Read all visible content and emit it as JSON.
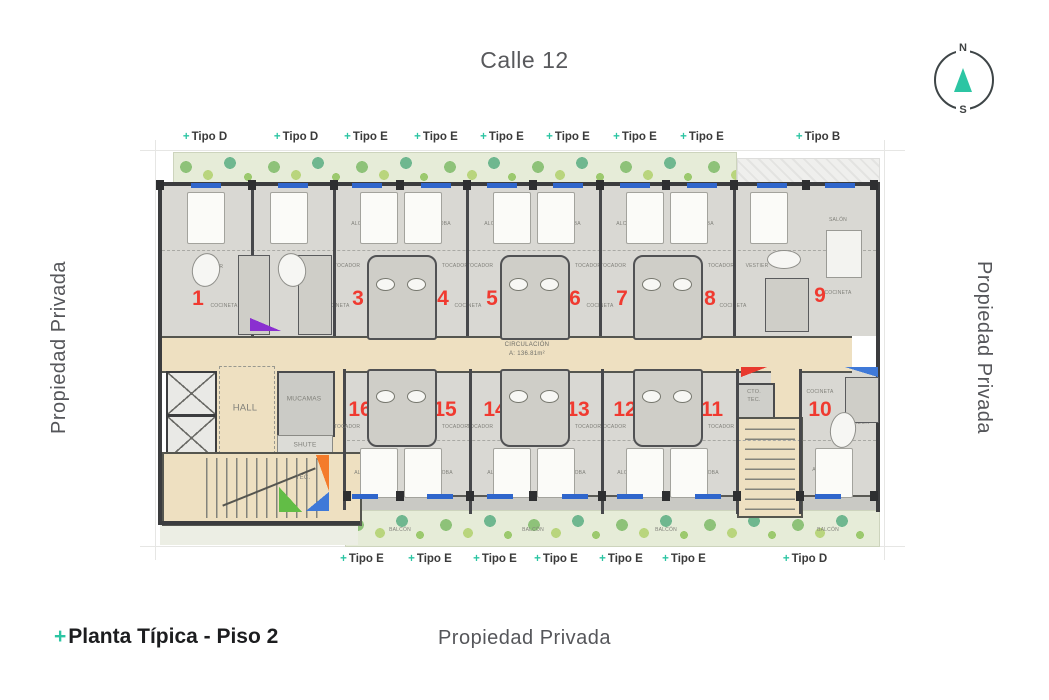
{
  "street_label": "Calle 12",
  "compass": {
    "north": "N",
    "south": "S",
    "needle_color": "#2cc5a3"
  },
  "side_labels": {
    "left": "Propiedad Privada",
    "right": "Propiedad Privada",
    "bottom": "Propiedad Privada"
  },
  "title": {
    "plus": "+",
    "text": "Planta Típica - Piso 2"
  },
  "colors": {
    "accent_teal": "#2cc5a3",
    "unit_number_red": "#f03a30",
    "corridor_beige": "#eee0c1",
    "building_gray": "#d9d8d3",
    "window_blue": "#2f66cc",
    "greenery_green": "#8ec279"
  },
  "corridor": {
    "line1": "CIRCULACIÓN",
    "line2": "A: 136.81m²"
  },
  "plan": {
    "type_labels_top": [
      {
        "label": "Tipo D",
        "x": 205
      },
      {
        "label": "Tipo D",
        "x": 296
      },
      {
        "label": "Tipo E",
        "x": 366
      },
      {
        "label": "Tipo E",
        "x": 436
      },
      {
        "label": "Tipo E",
        "x": 502
      },
      {
        "label": "Tipo E",
        "x": 568
      },
      {
        "label": "Tipo E",
        "x": 635
      },
      {
        "label": "Tipo E",
        "x": 702
      },
      {
        "label": "Tipo B",
        "x": 818
      }
    ],
    "type_labels_bottom": [
      {
        "label": "Tipo E",
        "x": 362
      },
      {
        "label": "Tipo E",
        "x": 430
      },
      {
        "label": "Tipo E",
        "x": 495
      },
      {
        "label": "Tipo E",
        "x": 556
      },
      {
        "label": "Tipo E",
        "x": 621
      },
      {
        "label": "Tipo E",
        "x": 684
      },
      {
        "label": "Tipo D",
        "x": 805
      }
    ],
    "unit_numbers": [
      {
        "n": "1",
        "x": 198,
        "y": 299
      },
      {
        "n": "2",
        "x": 310,
        "y": 299
      },
      {
        "n": "3",
        "x": 358,
        "y": 299
      },
      {
        "n": "4",
        "x": 443,
        "y": 299
      },
      {
        "n": "5",
        "x": 492,
        "y": 299
      },
      {
        "n": "6",
        "x": 575,
        "y": 299
      },
      {
        "n": "7",
        "x": 622,
        "y": 299
      },
      {
        "n": "8",
        "x": 710,
        "y": 299
      },
      {
        "n": "9",
        "x": 820,
        "y": 296
      },
      {
        "n": "10",
        "x": 820,
        "y": 410
      },
      {
        "n": "11",
        "x": 712,
        "y": 410
      },
      {
        "n": "12",
        "x": 625,
        "y": 410
      },
      {
        "n": "13",
        "x": 578,
        "y": 410
      },
      {
        "n": "14",
        "x": 495,
        "y": 410
      },
      {
        "n": "15",
        "x": 445,
        "y": 410
      },
      {
        "n": "16",
        "x": 360,
        "y": 410
      }
    ],
    "room_labels": [
      {
        "t": "HALL",
        "x": 245,
        "y": 408,
        "s": 9.5
      },
      {
        "t": "MUCAMAS",
        "x": 304,
        "y": 399,
        "s": 6.5
      },
      {
        "t": "SHUTE",
        "x": 305,
        "y": 445,
        "s": 6.5
      },
      {
        "t": "TEC.",
        "x": 303,
        "y": 478,
        "s": 6
      },
      {
        "t": "CTO.",
        "x": 754,
        "y": 392,
        "s": 5.5
      },
      {
        "t": "TEC.",
        "x": 754,
        "y": 400,
        "s": 5.5
      },
      {
        "t": "ALCOBA",
        "x": 205,
        "y": 224
      },
      {
        "t": "ALCOBA",
        "x": 292,
        "y": 224
      },
      {
        "t": "ALCOBA",
        "x": 362,
        "y": 224
      },
      {
        "t": "ALCOBA",
        "x": 440,
        "y": 224
      },
      {
        "t": "ALCOBA",
        "x": 495,
        "y": 224
      },
      {
        "t": "ALCOBA",
        "x": 570,
        "y": 224
      },
      {
        "t": "ALCOBA",
        "x": 627,
        "y": 224
      },
      {
        "t": "ALCOBA",
        "x": 703,
        "y": 224
      },
      {
        "t": "ALCOBA",
        "x": 770,
        "y": 220
      },
      {
        "t": "SALÓN",
        "x": 838,
        "y": 220
      },
      {
        "t": "TOCADOR",
        "x": 210,
        "y": 267
      },
      {
        "t": "TOCADOR",
        "x": 293,
        "y": 267
      },
      {
        "t": "TOCADOR",
        "x": 347,
        "y": 266
      },
      {
        "t": "TOCADOR",
        "x": 455,
        "y": 266
      },
      {
        "t": "TOCADOR",
        "x": 480,
        "y": 266
      },
      {
        "t": "TOCADOR",
        "x": 588,
        "y": 266
      },
      {
        "t": "TOCADOR",
        "x": 613,
        "y": 266
      },
      {
        "t": "TOCADOR",
        "x": 721,
        "y": 266
      },
      {
        "t": "VESTIER",
        "x": 757,
        "y": 266
      },
      {
        "t": "BAÑO",
        "x": 248,
        "y": 291
      },
      {
        "t": "BAÑO",
        "x": 313,
        "y": 291
      },
      {
        "t": "BAÑO",
        "x": 385,
        "y": 289
      },
      {
        "t": "BAÑO",
        "x": 415,
        "y": 289
      },
      {
        "t": "BAÑO",
        "x": 518,
        "y": 289
      },
      {
        "t": "BAÑO",
        "x": 548,
        "y": 289
      },
      {
        "t": "BAÑO",
        "x": 651,
        "y": 289
      },
      {
        "t": "BAÑO",
        "x": 681,
        "y": 289
      },
      {
        "t": "BAÑO",
        "x": 790,
        "y": 291
      },
      {
        "t": "COCINETA",
        "x": 224,
        "y": 306
      },
      {
        "t": "COCINETA",
        "x": 336,
        "y": 306
      },
      {
        "t": "COCINETA",
        "x": 384,
        "y": 306
      },
      {
        "t": "COCINETA",
        "x": 468,
        "y": 306
      },
      {
        "t": "COCINETA",
        "x": 517,
        "y": 306
      },
      {
        "t": "COCINETA",
        "x": 600,
        "y": 306
      },
      {
        "t": "COCINETA",
        "x": 650,
        "y": 306
      },
      {
        "t": "COCINETA",
        "x": 733,
        "y": 306
      },
      {
        "t": "COCINETA",
        "x": 838,
        "y": 293
      },
      {
        "t": "COCINETA",
        "x": 385,
        "y": 390
      },
      {
        "t": "COCINETA",
        "x": 420,
        "y": 390
      },
      {
        "t": "COCINETA",
        "x": 518,
        "y": 390
      },
      {
        "t": "COCINETA",
        "x": 553,
        "y": 390
      },
      {
        "t": "COCINETA",
        "x": 651,
        "y": 390
      },
      {
        "t": "COCINETA",
        "x": 686,
        "y": 390
      },
      {
        "t": "COCINETA",
        "x": 820,
        "y": 392
      },
      {
        "t": "BAÑO",
        "x": 383,
        "y": 401
      },
      {
        "t": "BAÑO",
        "x": 417,
        "y": 401
      },
      {
        "t": "BAÑO",
        "x": 516,
        "y": 401
      },
      {
        "t": "BAÑO",
        "x": 550,
        "y": 401
      },
      {
        "t": "BAÑO",
        "x": 649,
        "y": 401
      },
      {
        "t": "BAÑO",
        "x": 683,
        "y": 401
      },
      {
        "t": "BAÑO",
        "x": 853,
        "y": 399
      },
      {
        "t": "TOCADOR",
        "x": 347,
        "y": 427
      },
      {
        "t": "TOCADOR",
        "x": 455,
        "y": 427
      },
      {
        "t": "TOCADOR",
        "x": 480,
        "y": 427
      },
      {
        "t": "TOCADOR",
        "x": 588,
        "y": 427
      },
      {
        "t": "TOCADOR",
        "x": 613,
        "y": 427
      },
      {
        "t": "TOCADOR",
        "x": 721,
        "y": 427
      },
      {
        "t": "TOCADOR",
        "x": 856,
        "y": 423
      },
      {
        "t": "ALCOBA",
        "x": 365,
        "y": 473
      },
      {
        "t": "ALCOBA",
        "x": 442,
        "y": 473
      },
      {
        "t": "ALCOBA",
        "x": 498,
        "y": 473
      },
      {
        "t": "ALCOBA",
        "x": 575,
        "y": 473
      },
      {
        "t": "ALCOBA",
        "x": 628,
        "y": 473
      },
      {
        "t": "ALCOBA",
        "x": 708,
        "y": 473
      },
      {
        "t": "ALCOBA",
        "x": 823,
        "y": 470
      },
      {
        "t": "BALCÓN",
        "x": 400,
        "y": 530
      },
      {
        "t": "BALCÓN",
        "x": 533,
        "y": 530
      },
      {
        "t": "BALCÓN",
        "x": 666,
        "y": 530
      },
      {
        "t": "BALCÓN",
        "x": 828,
        "y": 530
      }
    ],
    "dividers_top": [
      252,
      334,
      467,
      600,
      734
    ],
    "dividers_bottom": [
      470,
      602,
      737,
      800
    ],
    "cores_top": [
      400,
      533,
      666
    ],
    "cores_bottom": [
      400,
      533,
      666
    ],
    "baths": [
      {
        "x": 238,
        "y": 255,
        "w": 30,
        "h": 78
      },
      {
        "x": 298,
        "y": 255,
        "w": 32,
        "h": 78
      },
      {
        "x": 765,
        "y": 278,
        "w": 42,
        "h": 52
      },
      {
        "x": 845,
        "y": 377,
        "w": 32,
        "h": 44
      }
    ],
    "beds_top": [
      205,
      288,
      378,
      422,
      511,
      555,
      644,
      688,
      768
    ],
    "beds_bottom": [
      378,
      422,
      511,
      555,
      644,
      688,
      833
    ],
    "tubs": [
      {
        "x": 192,
        "y": 253,
        "w": 26,
        "h": 32,
        "r": 12
      },
      {
        "x": 278,
        "y": 253,
        "w": 26,
        "h": 32,
        "r": -12
      },
      {
        "x": 767,
        "y": 250,
        "w": 32,
        "h": 17,
        "r": 0
      },
      {
        "x": 830,
        "y": 412,
        "w": 24,
        "h": 34,
        "r": 8
      }
    ],
    "furniture": [
      {
        "x": 826,
        "y": 230,
        "w": 34,
        "h": 46
      }
    ],
    "windows_top": [
      206,
      293,
      367,
      436,
      502,
      568,
      635,
      702,
      772,
      840
    ],
    "windows_bottom": [
      365,
      440,
      500,
      575,
      630,
      708,
      828
    ],
    "columns_top": [
      160,
      252,
      334,
      400,
      467,
      533,
      600,
      666,
      734,
      806,
      874
    ],
    "columns_bottom": [
      347,
      400,
      470,
      533,
      602,
      666,
      737,
      800,
      874
    ],
    "markers": [
      {
        "color": "#f47b2a",
        "x": 316,
        "y": 455,
        "w": 13,
        "h": 36,
        "dir": "tr"
      },
      {
        "color": "#62bd46",
        "x": 279,
        "y": 487,
        "w": 23,
        "h": 25,
        "dir": "bl"
      },
      {
        "color": "#3f79d8",
        "x": 306,
        "y": 492,
        "w": 23,
        "h": 19,
        "dir": "br"
      },
      {
        "color": "#e8392e",
        "x": 741,
        "y": 367,
        "w": 26,
        "h": 10,
        "dir": "tl"
      },
      {
        "color": "#3f79d8",
        "x": 845,
        "y": 367,
        "w": 33,
        "h": 10,
        "dir": "tr"
      },
      {
        "color": "#8a2fd0",
        "x": 250,
        "y": 318,
        "w": 31,
        "h": 13,
        "dir": "bl"
      }
    ]
  }
}
